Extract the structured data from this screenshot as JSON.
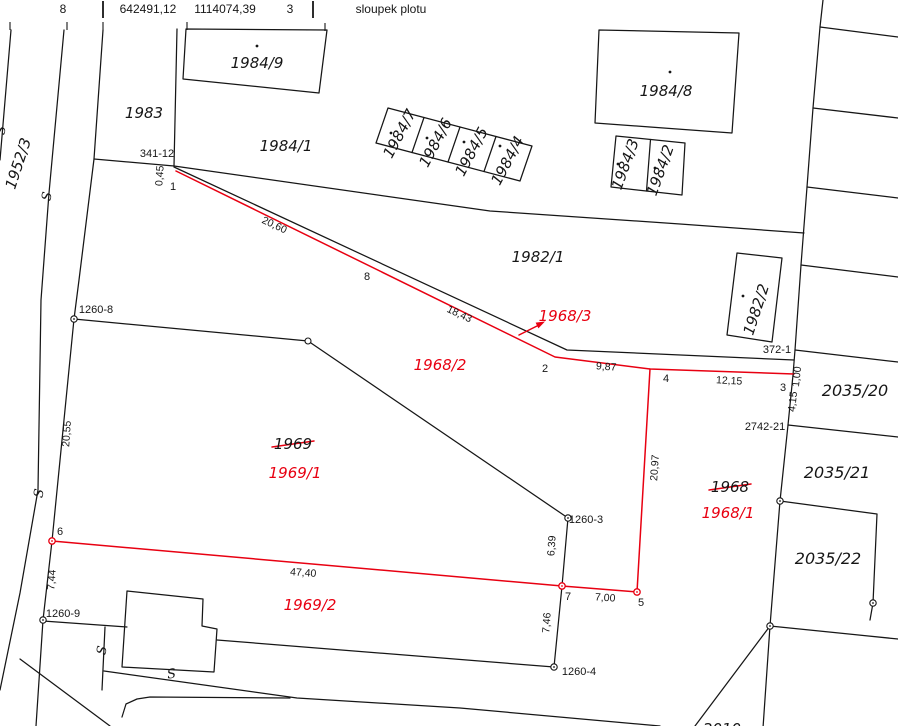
{
  "colors": {
    "black": "#161616",
    "red": "#e80011",
    "background": "#ffffff"
  },
  "table": {
    "point_number": "8",
    "coord_y": "642491,12",
    "coord_x": "1114074,39",
    "code": "3",
    "note": "sloupek plotu"
  },
  "parcels": {
    "n1952_3": "1952/3",
    "n1983": "1983",
    "n1984_9": "1984/9",
    "n1984_1": "1984/1",
    "n1984_7": "1984/7",
    "n1984_6": "1984/6",
    "n1984_5": "1984/5",
    "n1984_4": "1984/4",
    "n1984_8": "1984/8",
    "n1984_3": "1984/3",
    "n1984_2": "1984/2",
    "n1982_1": "1982/1",
    "n1982_2": "1982/2",
    "n2035_20": "2035/20",
    "n2035_21": "2035/21",
    "n2035_22": "2035/22",
    "n1969": "1969",
    "n1968": "1968",
    "n2010": "2010",
    "n1968_3": "1968/3",
    "n1968_2": "1968/2",
    "n1968_1": "1968/1",
    "n1969_1": "1969/1",
    "n1969_2": "1969/2"
  },
  "points": {
    "p341_12": "341-12",
    "p372_1": "372-1",
    "p2742_21": "2742-21",
    "p1260_8": "1260-8",
    "p1260_3": "1260-3",
    "p1260_9": "1260-9",
    "p1260_4": "1260-4",
    "n1": "1",
    "n2": "2",
    "n3": "3",
    "n4": "4",
    "n5": "5",
    "n6": "6",
    "n7": "7",
    "n8": "8"
  },
  "distances": {
    "d0_45": "0,45",
    "d20_60": "20,60",
    "d18_43": "18,43",
    "d9_87": "9,87",
    "d12_15": "12,15",
    "d1_00": "1,00",
    "d4_15": "4,15",
    "d20_97": "20,97",
    "d20_55": "20,55",
    "d6_39": "6,39",
    "d7_00": "7,00",
    "d47_40": "47,40",
    "d7_44": "7,44",
    "d7_46": "7,46"
  },
  "symbols": {
    "s_mark": "S"
  }
}
